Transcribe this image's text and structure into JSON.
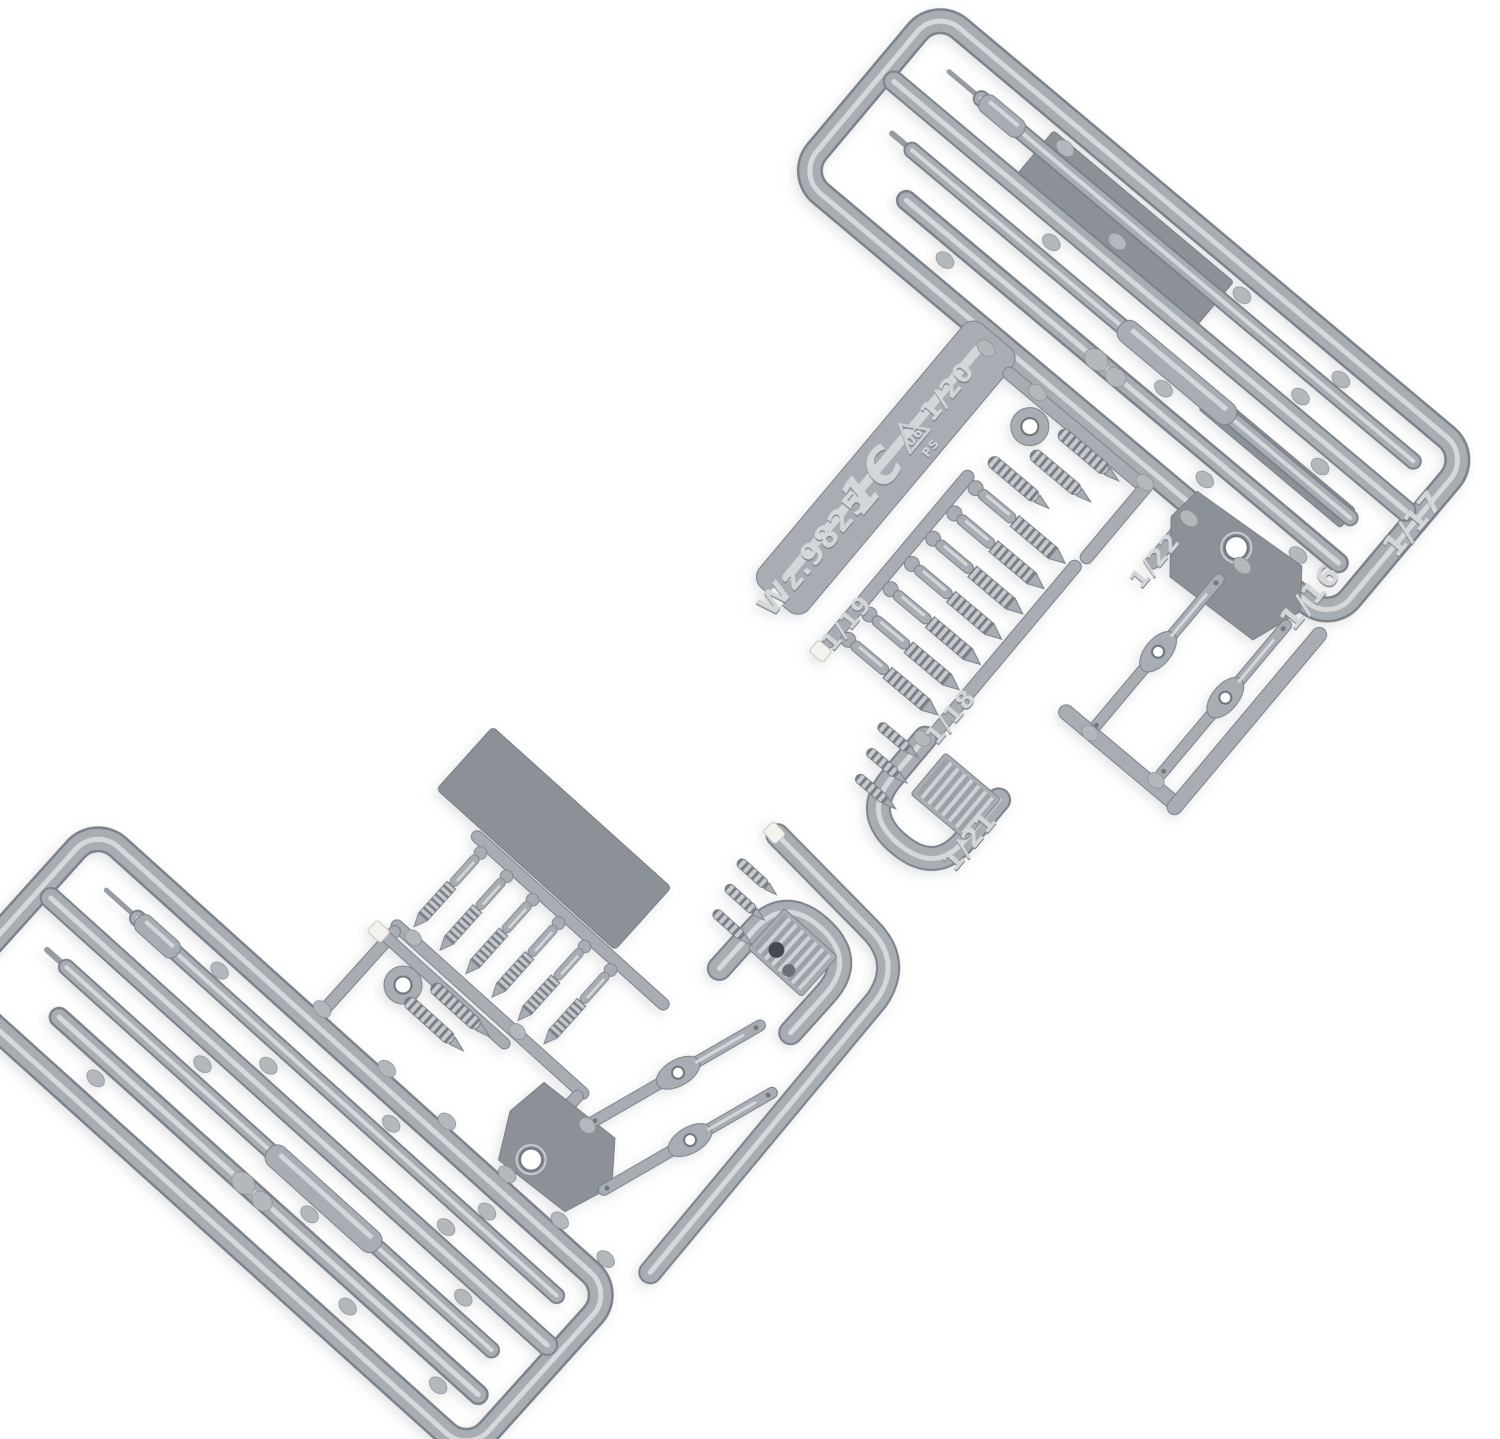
{
  "photo": {
    "subject": "Gray injection-molded polystyrene model-kit sprue of small rifle accessory parts (barrels, cleaning rods, springs, bolts, sling links), two interlocking sprue sections photographed on a white background",
    "background_color": "#ffffff"
  },
  "palette": {
    "plastic": "#a8adb3",
    "plastic_highlight": "#dadde0",
    "plastic_shadow": "#7b828a",
    "dark_flat_part": "#8b9197",
    "cut_mark_white": "#f3f2ec"
  },
  "markings": {
    "mold_code": "Wz.9825",
    "sprue_letter": "1C",
    "recycling_code": "06",
    "recycling_material": "PS",
    "part_numbers": [
      "1/16",
      "1/17",
      "1/18",
      "1/19",
      "1/20",
      "1/21",
      "1/22"
    ]
  }
}
